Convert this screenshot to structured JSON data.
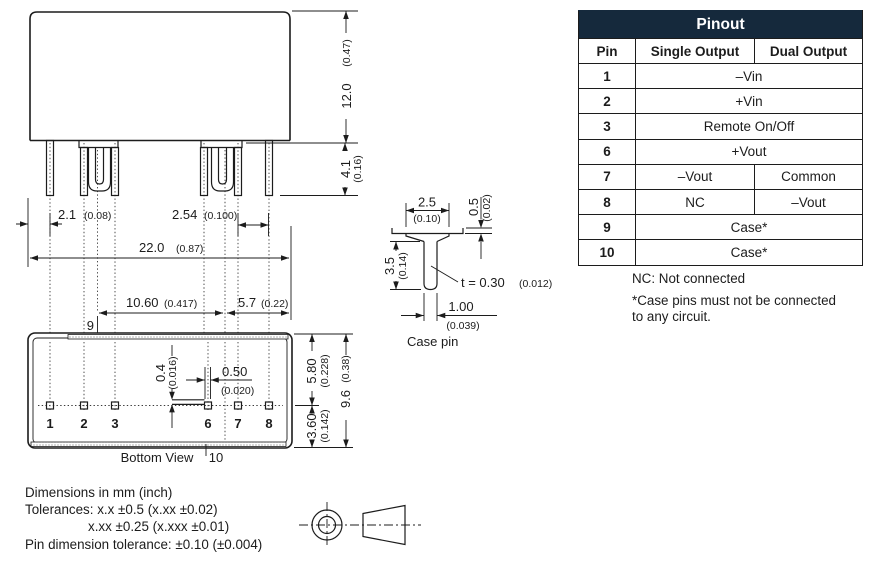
{
  "pinout": {
    "title": "Pinout",
    "col_pin": "Pin",
    "col_single": "Single Output",
    "col_dual": "Dual Output",
    "rows": [
      {
        "pin": "1",
        "span": "–Vin"
      },
      {
        "pin": "2",
        "span": "+Vin"
      },
      {
        "pin": "3",
        "span": "Remote On/Off"
      },
      {
        "pin": "6",
        "span": "+Vout"
      },
      {
        "pin": "7",
        "single": "–Vout",
        "dual": "Common"
      },
      {
        "pin": "8",
        "single": "NC",
        "dual": "–Vout"
      },
      {
        "pin": "9",
        "span": "Case*"
      },
      {
        "pin": "10",
        "span": "Case*"
      }
    ],
    "notes": [
      "NC: Not connected",
      "*Case pins must not be connected",
      "to any circuit."
    ],
    "header_bg": "#15293c"
  },
  "drawing": {
    "side_view": {
      "height_mm": "12.0",
      "height_in": "(0.47)",
      "pin_len_mm": "4.1",
      "pin_len_in": "(0.16)",
      "pin_offset_mm": "2.1",
      "pin_offset_in": "(0.08)",
      "pitch_mm": "2.54",
      "pitch_in": "(0.100)",
      "width_mm": "22.0",
      "width_in": "(0.87)"
    },
    "bottom_view": {
      "label": "Bottom View",
      "case_pitch_mm": "10.60",
      "case_pitch_in": "(0.417)",
      "case_edge_mm": "5.7",
      "case_edge_in": "(0.22)",
      "tab_mm": "0.4",
      "tab_in": "(0.016)",
      "pin_w_mm": "0.50",
      "pin_w_in": "(0.020)",
      "top_mm": "5.80",
      "top_in": "(0.228)",
      "bot_mm": "3.60",
      "bot_in": "(0.142)",
      "depth_mm": "9.6",
      "depth_in": "(0.38)",
      "pin_numbers": [
        "1",
        "2",
        "3",
        "6",
        "7",
        "8"
      ],
      "case_pin_top": "9",
      "case_pin_bottom": "10"
    },
    "case_pin": {
      "label": "Case pin",
      "w_mm": "2.5",
      "w_in": "(0.10)",
      "step_mm": "0.5",
      "step_in": "(0.02)",
      "len_mm": "3.5",
      "len_in": "(0.14)",
      "thickness": "t = 0.30",
      "thickness_in": "(0.012)",
      "tab_w_mm": "1.00",
      "tab_w_in": "(0.039)"
    }
  },
  "footer": {
    "line1": "Dimensions in mm (inch)",
    "line2": "Tolerances: x.x ±0.5 (x.xx ±0.02)",
    "line3": "x.xx ±0.25 (x.xxx ±0.01)",
    "line4": "Pin dimension tolerance: ±0.10 (±0.004)"
  }
}
